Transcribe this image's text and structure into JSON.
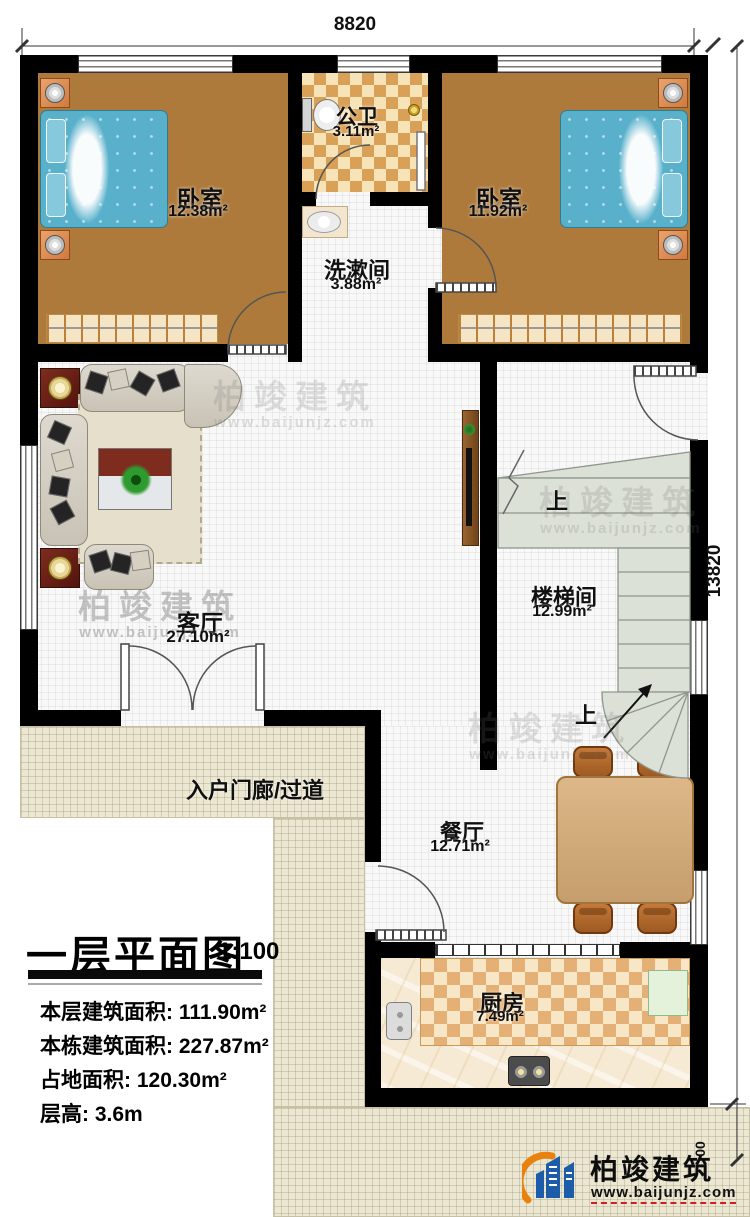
{
  "title_block": {
    "title": "一层平面图",
    "scale": "1:100",
    "stats": [
      {
        "label": "本层建筑面积:",
        "value": "111.90m²"
      },
      {
        "label": "本栋建筑面积:",
        "value": "227.87m²"
      },
      {
        "label": "占地面积:",
        "value": "120.30m²"
      },
      {
        "label": "层高:",
        "value": "3.6m"
      }
    ]
  },
  "dimensions": {
    "top": "8820",
    "right": "13820",
    "right_lower": "00"
  },
  "rooms": {
    "bedroom_left": {
      "name": "卧室",
      "area": "12.38m²"
    },
    "bathroom": {
      "name": "公卫",
      "area": "3.11m²"
    },
    "bedroom_right": {
      "name": "卧室",
      "area": "11.92m²"
    },
    "washroom": {
      "name": "洗漱间",
      "area": "3.88m²"
    },
    "living": {
      "name": "客厅",
      "area": "27.10m²"
    },
    "stairwell": {
      "name": "楼梯间",
      "area": "12.99m²"
    },
    "dining": {
      "name": "餐厅",
      "area": "12.71m²"
    },
    "kitchen": {
      "name": "厨房",
      "area": "7.49m²"
    },
    "porch": {
      "name": "入户门廊/过道"
    }
  },
  "stairs": {
    "up": "上"
  },
  "watermark": {
    "brand": "柏竣建筑",
    "url": "www.baijunjz.com"
  },
  "logo": {
    "brand": "柏竣建筑",
    "url": "www.baijunjz.com"
  },
  "colors": {
    "wall": "#000000",
    "wood_floor": "#ad7a3c",
    "bath_tile": "#d9a158",
    "bed": "#58b0cb",
    "stair_fill": "#dce1d7",
    "logo_blue": "#1d5ca8",
    "logo_orange": "#e8820c",
    "url_underline_red": "#cf1f1f"
  }
}
